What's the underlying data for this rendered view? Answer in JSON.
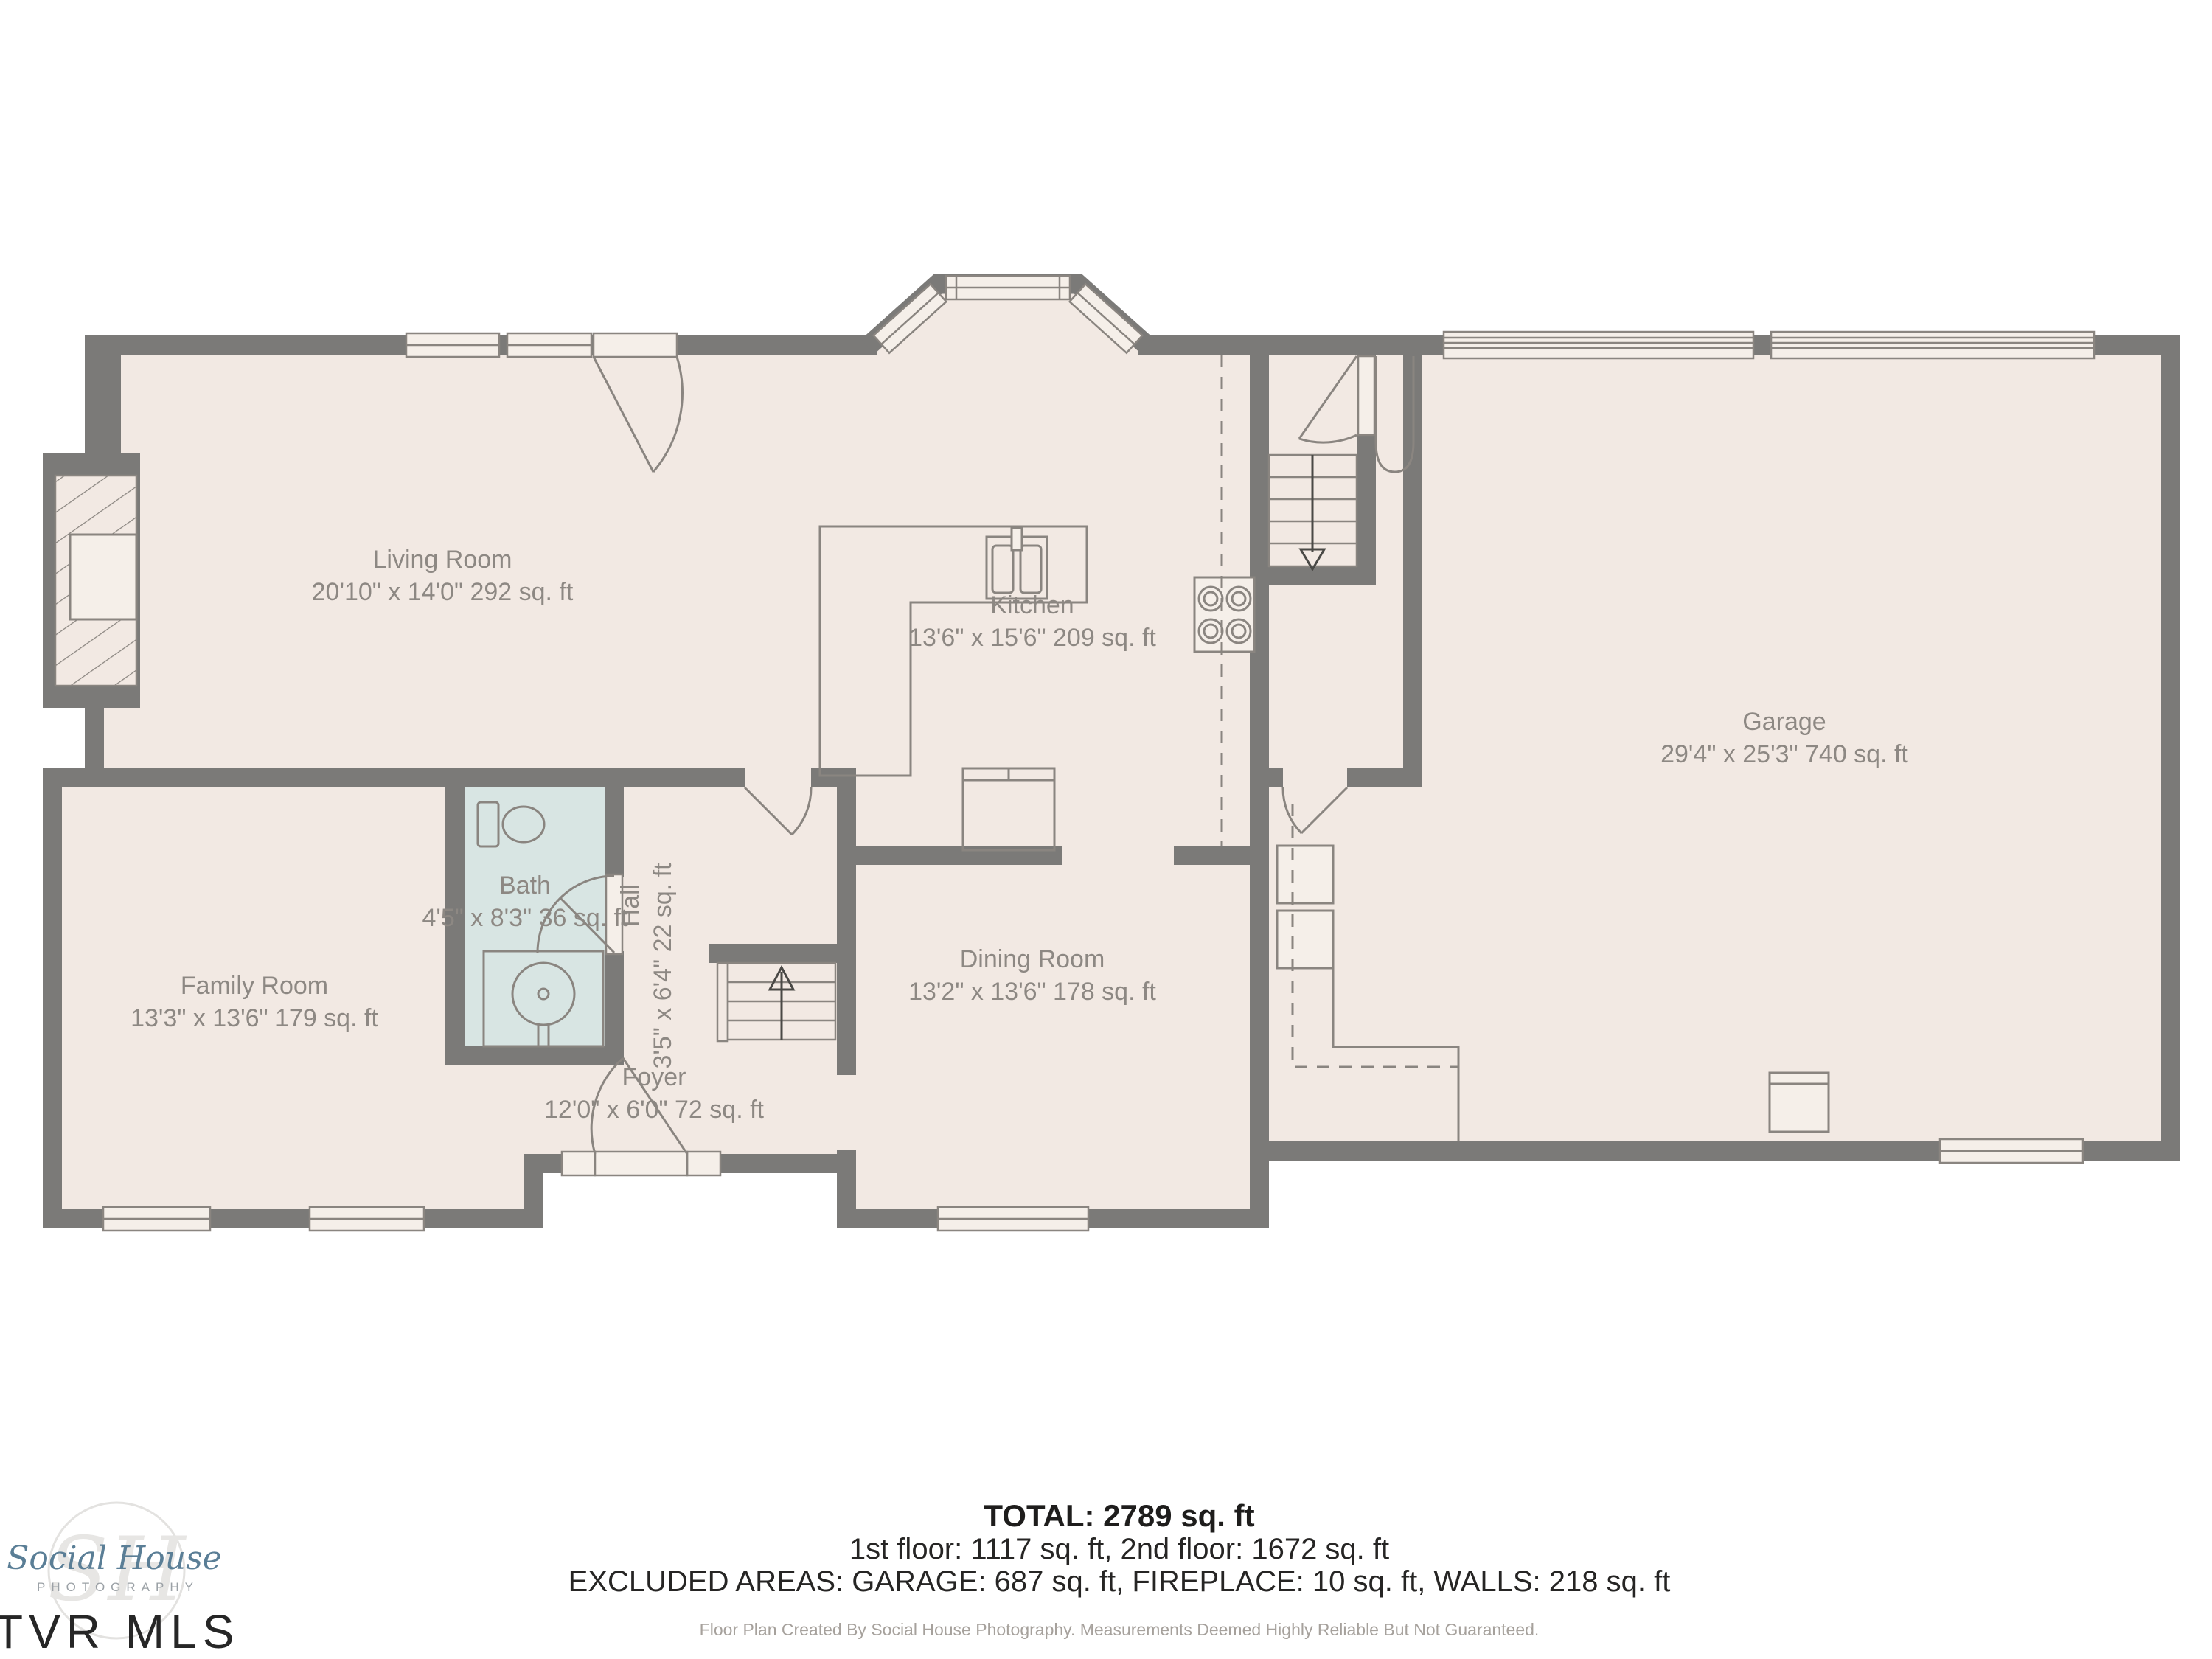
{
  "rooms": {
    "living": {
      "name": "Living Room",
      "dims": "20'10\" x 14'0\" 292 sq. ft"
    },
    "kitchen": {
      "name": "Kitchen",
      "dims": "13'6\" x 15'6\" 209 sq. ft"
    },
    "garage": {
      "name": "Garage",
      "dims": "29'4\" x 25'3\" 740 sq. ft"
    },
    "family": {
      "name": "Family Room",
      "dims": "13'3\" x 13'6\" 179 sq. ft"
    },
    "bath": {
      "name": "Bath",
      "dims": "4'5\" x 8'3\" 36 sq. ft"
    },
    "hall": {
      "name": "Hall",
      "dims": "3'5\" x 6'4\" 22 sq. ft"
    },
    "dining": {
      "name": "Dining Room",
      "dims": "13'2\" x 13'6\" 178 sq. ft"
    },
    "foyer": {
      "name": "Foyer",
      "dims": "12'0\" x 6'0\" 72 sq. ft"
    }
  },
  "summary": {
    "total": "TOTAL: 2789 sq. ft",
    "floors": "1st floor: 1117 sq. ft, 2nd floor: 1672 sq. ft",
    "excluded": "EXCLUDED AREAS: GARAGE: 687 sq. ft, FIREPLACE: 10 sq. ft, WALLS: 218 sq. ft",
    "disclaimer": "Floor Plan Created By Social House Photography. Measurements Deemed Highly Reliable But Not Guaranteed."
  },
  "branding": {
    "script": "Social House",
    "sub": "PHOTOGRAPHY",
    "mls": "TVR MLS",
    "monogram": "SH"
  },
  "colors": {
    "floor": "#f2e9e3",
    "wall": "#7b7a78",
    "bath_fill": "#d8e5e3",
    "label_text": "#8d8883",
    "logo_blue": "#5a7e96"
  }
}
